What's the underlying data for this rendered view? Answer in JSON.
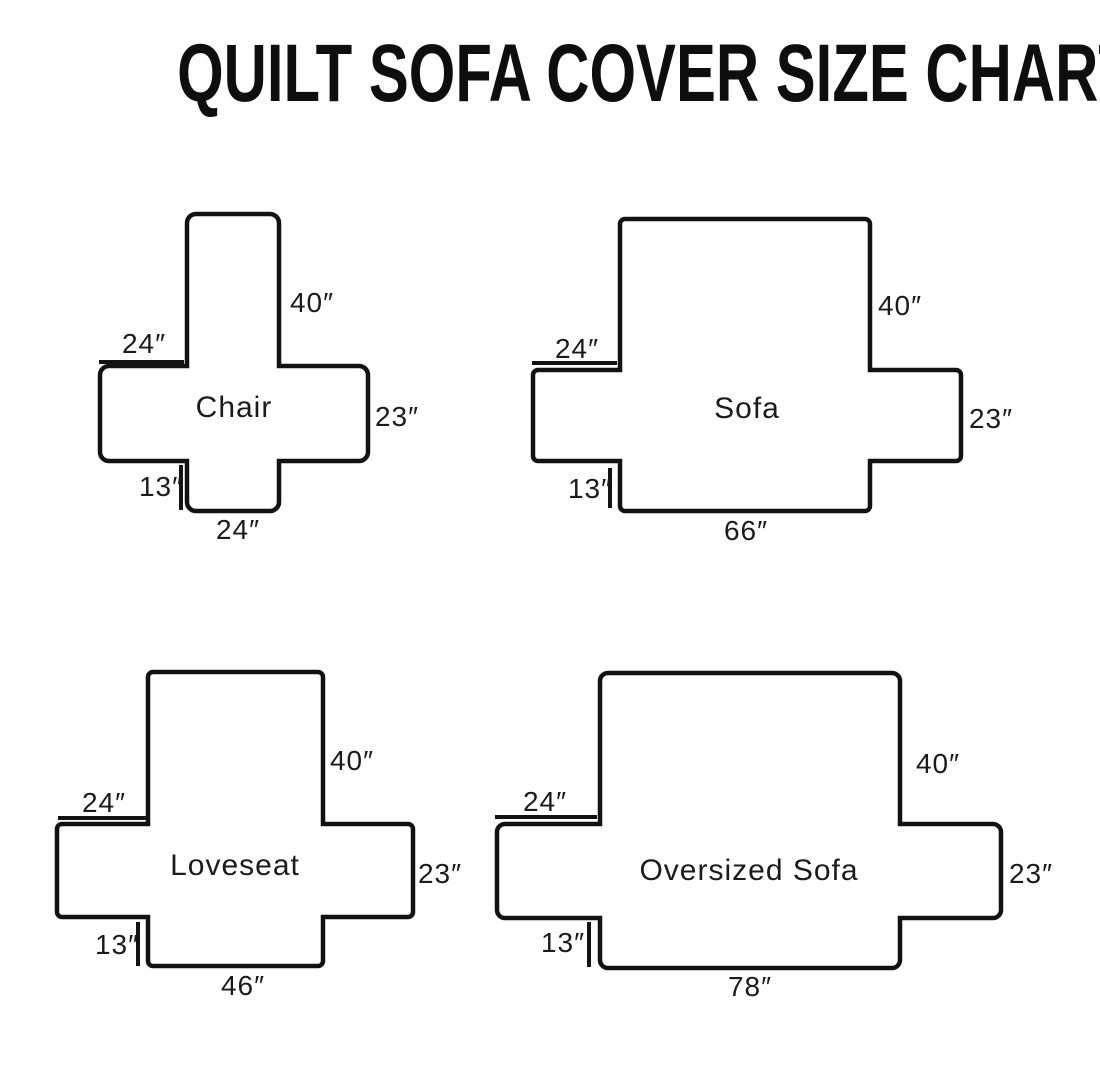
{
  "title": "QUILT SOFA COVER SIZE CHART",
  "colors": {
    "line": "#121212",
    "background": "#ffffff",
    "text": "#1b1b1b"
  },
  "diagrams": [
    {
      "name": "Chair",
      "back_height": "40″",
      "arm_top_width": "24″",
      "arm_front_height": "23″",
      "skirt_height": "13″",
      "front_width": "24″"
    },
    {
      "name": "Sofa",
      "back_height": "40″",
      "arm_top_width": "24″",
      "arm_front_height": "23″",
      "skirt_height": "13″",
      "front_width": "66″"
    },
    {
      "name": "Loveseat",
      "back_height": "40″",
      "arm_top_width": "24″",
      "arm_front_height": "23″",
      "skirt_height": "13″",
      "front_width": "46″"
    },
    {
      "name": "Oversized Sofa",
      "back_height": "40″",
      "arm_top_width": "24″",
      "arm_front_height": "23″",
      "skirt_height": "13″",
      "front_width": "78″"
    }
  ]
}
